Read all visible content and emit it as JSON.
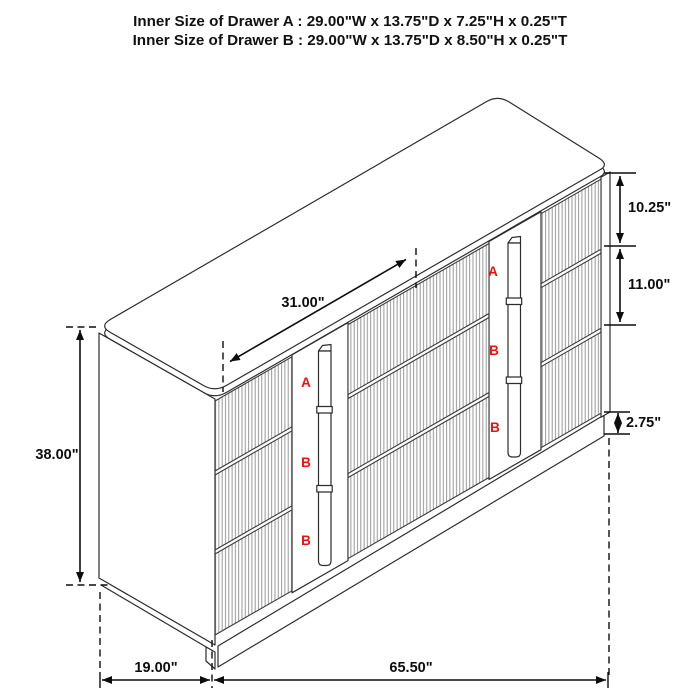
{
  "title": {
    "line1": "Inner Size of Drawer A : 29.00\"W x 13.75\"D x 7.25\"H x 0.25\"T",
    "line2": "Inner Size of Drawer B : 29.00\"W x 13.75\"D x 8.50\"H x 0.25\"T"
  },
  "dimensions": {
    "overall_height": "38.00\"",
    "top_section_width": "31.00\"",
    "drawer_a_front_height": "10.25\"",
    "drawer_b_front_height": "11.00\"",
    "base_height": "2.75\"",
    "depth": "19.00\"",
    "overall_width": "65.50\""
  },
  "drawer_labels": {
    "left_column": [
      "A",
      "B",
      "B"
    ],
    "right_column": [
      "A",
      "B",
      "B"
    ]
  },
  "colors": {
    "label_red": "#ee1010",
    "line_dark": "#2d2d2d",
    "flute_gray": "#8d8d8d",
    "dimension_black": "#0d0d0d"
  }
}
